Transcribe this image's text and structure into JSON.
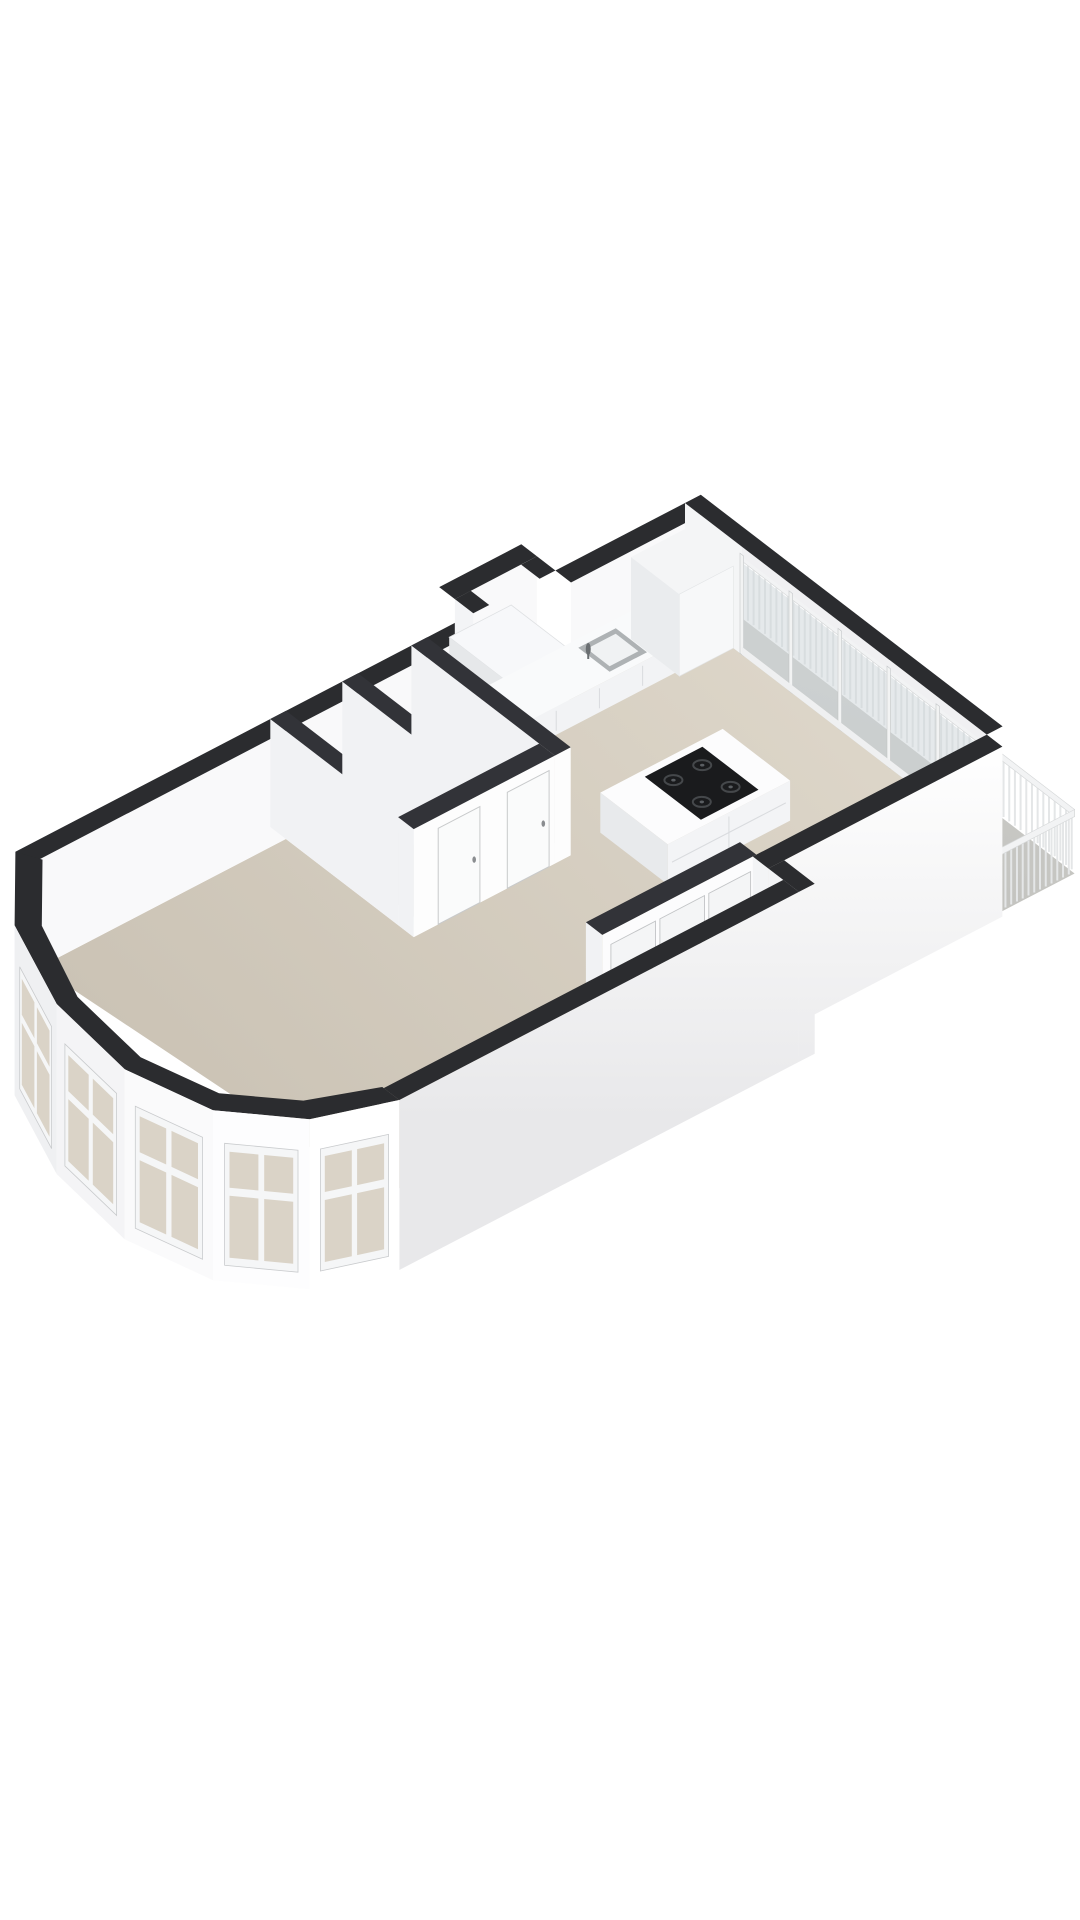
{
  "scene": {
    "kind": "3d-floorplan-axonometric-render",
    "background": "#ffffff",
    "projection": {
      "origin": [
        -35,
        878
      ],
      "u": [
        0.72,
        -0.375
      ],
      "v": [
        0.71,
        0.545
      ],
      "dz_floor": 108,
      "dz_exterior": 170,
      "dz_balcony_floor": 116,
      "dz_counter": 80,
      "dz_island": 68,
      "dz_washer": 48,
      "dz_cabinet": 26,
      "dz_rail_top": 52,
      "dz_rail_base": 114
    },
    "colors": {
      "band_ext": "#2b2c2f",
      "band_int": "#323338",
      "ext_face_light": "#ffffff",
      "ext_face_dark": "#eaeaec",
      "ext_face_sw": "#f3f4f6",
      "inner_nw": "#f9f9fa",
      "inner_mu": "#f1f2f4",
      "room_floor": "#e9e8e5",
      "closet_floor": "#e7e6e3",
      "niche_floor": "#eceae6",
      "floor_light": "#ded7ca",
      "floor_dark": "#c9c1b3",
      "balcony_floor": "#cacac6",
      "glass": "#cdd5d9",
      "glass_frame": "#f2f3f3",
      "glass_frame_edge": "#c4c7c9",
      "bay_pane": "#dad3c7",
      "bay_frame": "#f5f6f7",
      "bay_frame_edge": "#c9cbcd",
      "bay_face_1": "#eff0f2",
      "bay_face_2": "#f4f4f6",
      "bay_face_3": "#fafafb",
      "bay_face_4": "#fdfdfe",
      "bay_face_5": "#ffffff",
      "bay_inner_0": "#f8f8f9",
      "bay_inner_1": "#f2f3f5",
      "rail_bar": "#e4e6e7",
      "rail_top": "#f2f3f4",
      "rail_edge": "#d7d9da",
      "island_top": "#fcfcfd",
      "island_front": "#f3f4f6",
      "island_side": "#e8eaec",
      "seam": "#d9dbde",
      "cooktop": "#1a1b1d",
      "burner": "#45484b",
      "burner_dot": "#5a5e62",
      "counter_top": "#f9fafb",
      "counter_front": "#f2f3f5",
      "counter_side": "#e9ebed",
      "washer_top": "#f7f8fa",
      "washer_front": "#f0f1f3",
      "washer_side": "#e6e8ea",
      "cabinet_top": "#f4f5f6",
      "cabinet_front": "#f7f8f9",
      "cabinet_side": "#eaecee",
      "door": "#fafbfb",
      "door_edge": "#c8cacb",
      "panel": "#f4f5f6",
      "panel_edge": "#c2c4c6",
      "handle": "#8a8d90",
      "sink_ring": "#aeb2b4",
      "sink_basin": "#f0f2f3",
      "faucet": "#6a6e71"
    },
    "rooms": [
      {
        "name": "living-room"
      },
      {
        "name": "hallway"
      },
      {
        "name": "storage-room-1"
      },
      {
        "name": "storage-room-2"
      },
      {
        "name": "kitchen"
      },
      {
        "name": "balcony"
      },
      {
        "name": "closet"
      }
    ],
    "bay": {
      "outer": [
        [
          70,
          0
        ],
        [
          -10,
          80
        ],
        [
          -60,
          190
        ],
        [
          -74,
          300
        ],
        [
          -45,
          395
        ],
        [
          25,
          460
        ],
        [
          120,
          490
        ]
      ],
      "inner": [
        [
          84,
          24
        ],
        [
          12,
          96
        ],
        [
          -35,
          194
        ],
        [
          -48,
          296
        ],
        [
          -22,
          380
        ],
        [
          40,
          436
        ],
        [
          120,
          466
        ]
      ],
      "window_facets": [
        1,
        2,
        3,
        4,
        5
      ],
      "inner_face_facets": [
        0,
        1
      ],
      "face_colors": [
        "bay_face_1",
        "bay_face_1",
        "bay_face_2",
        "bay_face_3",
        "bay_face_4",
        "bay_face_5"
      ]
    },
    "floors": {
      "main": [
        [
          82,
          22
        ],
        [
          424,
          22
        ],
        [
          424,
          202
        ],
        [
          642,
          202
        ],
        [
          642,
          22
        ],
        [
          1000,
          22
        ],
        [
          1000,
          425
        ],
        [
          675,
          425
        ],
        [
          675,
          468
        ],
        [
          120,
          468
        ]
      ],
      "room1": [
        [
          446,
          22
        ],
        [
          524,
          22
        ],
        [
          524,
          180
        ],
        [
          446,
          180
        ]
      ],
      "room2": [
        [
          546,
          22
        ],
        [
          620,
          22
        ],
        [
          620,
          180
        ],
        [
          546,
          180
        ]
      ],
      "closet_strip": [
        [
          466,
          425
        ],
        [
          680,
          425
        ],
        [
          680,
          468
        ],
        [
          466,
          468
        ]
      ],
      "niche": [
        [
          706,
          -26
        ],
        [
          820,
          -26
        ],
        [
          820,
          22
        ],
        [
          706,
          22
        ]
      ]
    },
    "walls": {
      "nw_a": {
        "x1": 70,
        "x2": 706,
        "y1": 0,
        "y2": 22
      },
      "nw_b": {
        "x1": 820,
        "x2": 1000,
        "y1": 0,
        "y2": 22
      },
      "niche_back": {
        "x1": 706,
        "x2": 820,
        "y1": -48,
        "y2": -26
      },
      "niche_left": {
        "x1": 706,
        "x2": 728,
        "y1": -26,
        "y2": 0
      },
      "niche_right": {
        "x1": 798,
        "x2": 820,
        "y1": -26,
        "y2": 0
      },
      "ne_glass": {
        "x1": 1000,
        "x2": 1022,
        "y1": 0,
        "y2": 425
      },
      "w1": {
        "x1": 424,
        "x2": 446,
        "y1": 0,
        "y2": 180
      },
      "w3": {
        "x1": 524,
        "x2": 546,
        "y1": 0,
        "y2": 180
      },
      "w4": {
        "x1": 620,
        "x2": 642,
        "y1": 0,
        "y2": 202
      },
      "w2": {
        "x1": 424,
        "x2": 620,
        "y1": 180,
        "y2": 202
      },
      "w5": {
        "x1": 466,
        "x2": 680,
        "y1": 402,
        "y2": 425
      },
      "se_kitchen": {
        "x1": 675,
        "x2": 1000,
        "y1": 425,
        "y2": 447
      },
      "se_connector": {
        "x1": 675,
        "x2": 697,
        "y1": 447,
        "y2": 490
      },
      "se_living": {
        "x1": 120,
        "x2": 675,
        "y1": 468,
        "y2": 490
      }
    },
    "glass_wall": {
      "plane_x": 1000,
      "y_start": 80,
      "y_end": 425,
      "divisions": [
        80,
        149,
        218,
        287,
        356,
        425
      ],
      "pane_dz": [
        16,
        100
      ],
      "frame_dz": [
        8,
        108
      ]
    },
    "balcony": {
      "floor": [
        [
          1000,
          -75
        ],
        [
          1048,
          -75
        ],
        [
          1048,
          500
        ],
        [
          920,
          500
        ],
        [
          920,
          447
        ],
        [
          1000,
          447
        ]
      ],
      "rail_outer_x": 1048,
      "rail_y_start": -40,
      "rail_y_end": 500,
      "rail_x_end": 920,
      "bar_step": 8
    },
    "kitchen": {
      "counter": {
        "x1": 642,
        "x2": 925,
        "y1": 0,
        "y2": 62,
        "seams": [
          700,
          760,
          820,
          880
        ]
      },
      "sink": {
        "x1": 842,
        "y1": 10,
        "x2": 894,
        "y2": 54,
        "faucet": [
          838,
          28
        ]
      },
      "washer": {
        "x1": 712,
        "x2": 798,
        "y1": -40,
        "y2": 42
      },
      "cabinet": {
        "x1": 925,
        "x2": 1000,
        "y1": 0,
        "y2": 68
      },
      "island": {
        "x1": 691,
        "x2": 861,
        "y1": 194,
        "y2": 289
      },
      "cooktop": {
        "x1": 745,
        "x2": 825,
        "y1": 202,
        "y2": 281
      },
      "burners": [
        [
          765,
          222
        ],
        [
          805,
          222
        ],
        [
          765,
          262
        ],
        [
          805,
          262
        ]
      ]
    },
    "doors": {
      "room_doors": [
        {
          "x1": 458,
          "x2": 516
        },
        {
          "x1": 554,
          "x2": 612
        }
      ],
      "door_dz": [
        12,
        108
      ],
      "closet_panels": [
        [
          478,
          540
        ],
        [
          546,
          608
        ],
        [
          614,
          672
        ]
      ],
      "closet_dz": [
        14,
        104
      ]
    }
  }
}
